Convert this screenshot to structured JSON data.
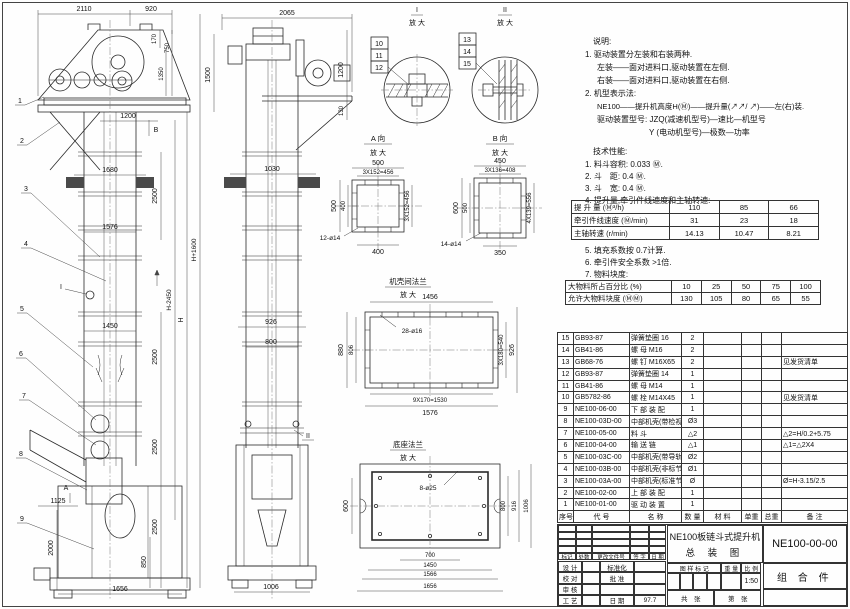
{
  "drawing": {
    "fv": {
      "d2110": "2110",
      "d920": "920",
      "d170": "170",
      "d750": "750",
      "d1350": "1350",
      "d1500": "1500",
      "d1200": "1200",
      "d1680": "1680",
      "d2500": "2500",
      "d1576": "1576",
      "d1450": "1450",
      "dH2450": "H-2450",
      "dH": "H",
      "dH1600": "H+1600",
      "d1125": "1125",
      "d2000": "2000",
      "d850": "850",
      "d1656": "1656",
      "mA": "A",
      "mB": "B",
      "mI": "I"
    },
    "sv": {
      "d2065": "2065",
      "d1200": "1200",
      "d130": "130",
      "d1030": "1030",
      "d926": "926",
      "d800": "800",
      "d1006": "1006",
      "mII": "II"
    },
    "det1": {
      "t": "I",
      "s": "放 大",
      "b1": "10",
      "b2": "11",
      "b3": "12"
    },
    "det2": {
      "t": "II",
      "s": "放 大",
      "b1": "13",
      "b2": "14",
      "b3": "15"
    },
    "va": {
      "t": "A 向",
      "s": "放 大",
      "top1": "500",
      "top2": "3X152=456",
      "l1": "500",
      "l2": "400",
      "r1": "3X152=456",
      "bot": "400",
      "leader": "12-ø14"
    },
    "vb": {
      "t": "B 向",
      "s": "放 大",
      "top1": "450",
      "top2": "3X136=408",
      "l1": "600",
      "l2": "500",
      "r1": "4X139=556",
      "bot": "350",
      "leader": "14-ø14"
    },
    "fm": {
      "t": "机壳间法兰",
      "s": "放 大",
      "top": "1456",
      "leader": "28-ø16",
      "l1": "880",
      "l2": "806",
      "r1": "3X180=540",
      "r2": "926",
      "b1": "9X170=1530",
      "b2": "1576"
    },
    "fb": {
      "t": "底座法兰",
      "s": "放 大",
      "leader": "8-ø25",
      "l1": "600",
      "r1": "800",
      "r2": "916",
      "r3": "1006",
      "b1": "700",
      "b2": "1450",
      "b3": "1566",
      "b4": "1656"
    },
    "bal": {
      "n1": "1",
      "n2": "2",
      "n3": "3",
      "n4": "4",
      "n5": "5",
      "n6": "6",
      "n7": "7",
      "n8": "8",
      "n9": "9"
    }
  },
  "notes": {
    "heading": "说明:",
    "l1": "1. 驱动装置分左装和右装两种.",
    "l2": "左装——面对进料口,驱动装置在左侧.",
    "l3": "右装——面对进料口,驱动装置在右侧.",
    "l4": "2. 机型表示法:",
    "l5": "NE100——提升机高度H(Ⓜ)——提升量(↗↗/ ↗)——左(右)装.",
    "l6": "驱动装置型号: JZQ(减速机型号)—速比—机型号",
    "l7": "Y (电动机型号)—极数—功率"
  },
  "tech": {
    "heading": "技术性能:",
    "i1": "1. 料斗容积: 0.033 Ⓜ.",
    "i2": "2. 斗　距: 0.4 Ⓜ.",
    "i3": "3. 斗　宽: 0.4 Ⓜ.",
    "i4": "4. 提升量,牵引件线速度和主轴转速:",
    "perf": {
      "rows": [
        {
          "label": "提 升 量  (Ⓜ³/h)",
          "v": [
            "110",
            "85",
            "66"
          ]
        },
        {
          "label": "牵引件线速度 (Ⓜ/min)",
          "v": [
            "31",
            "23",
            "18"
          ]
        },
        {
          "label": "主轴转速 (r/min)",
          "v": [
            "14.13",
            "10.47",
            "8.21"
          ]
        }
      ]
    },
    "i5": "5. 填充系数按 0.7计算.",
    "i6": "6. 牵引件安全系数 >1倍.",
    "i7": "7. 物料块度:",
    "lump": {
      "rows": [
        {
          "label": "大物料所占百分比 (%)",
          "v": [
            "10",
            "25",
            "50",
            "75",
            "100"
          ]
        },
        {
          "label": "允许大物料块度 (ⓂⓂ)",
          "v": [
            "130",
            "105",
            "80",
            "65",
            "55"
          ]
        }
      ]
    }
  },
  "bom": {
    "headers": [
      "序号",
      "代  号",
      "名    称",
      "数 量",
      "材  料",
      "单重",
      "总重",
      "备  注"
    ],
    "rows": [
      {
        "no": "15",
        "code": "GB93-87",
        "name": "弹簧垫圈 16",
        "qty": "2",
        "mat": "",
        "w1": "",
        "w2": "",
        "rem": ""
      },
      {
        "no": "14",
        "code": "GB41-86",
        "name": "螺  母  M16",
        "qty": "2",
        "mat": "",
        "w1": "",
        "w2": "",
        "rem": ""
      },
      {
        "no": "13",
        "code": "GB68-76",
        "name": "螺  钉  M16X65",
        "qty": "2",
        "mat": "",
        "w1": "",
        "w2": "",
        "rem": "见发货清单"
      },
      {
        "no": "12",
        "code": "GB93-87",
        "name": "弹簧垫圈 14",
        "qty": "1",
        "mat": "",
        "w1": "",
        "w2": "",
        "rem": ""
      },
      {
        "no": "11",
        "code": "GB41-86",
        "name": "螺  母  M14",
        "qty": "1",
        "mat": "",
        "w1": "",
        "w2": "",
        "rem": ""
      },
      {
        "no": "10",
        "code": "GB5782-86",
        "name": "螺  栓  M14X45",
        "qty": "1",
        "mat": "",
        "w1": "",
        "w2": "",
        "rem": "见发货清单"
      },
      {
        "no": "9",
        "code": "NE100-06-00",
        "name": "下 部 装 配",
        "qty": "1",
        "mat": "",
        "w1": "",
        "w2": "",
        "rem": ""
      },
      {
        "no": "8",
        "code": "NE100-03D-00",
        "name": "中部机壳(带检视门)",
        "qty": "Ø3",
        "mat": "",
        "w1": "",
        "w2": "",
        "rem": ""
      },
      {
        "no": "7",
        "code": "NE100-05-00",
        "name": "料  斗",
        "qty": "△2",
        "mat": "",
        "w1": "",
        "w2": "",
        "rem": "△2=H/0.2+5.75"
      },
      {
        "no": "6",
        "code": "NE100-04-00",
        "name": "输 送 链",
        "qty": "△1",
        "mat": "",
        "w1": "",
        "w2": "",
        "rem": "△1=△2X4"
      },
      {
        "no": "5",
        "code": "NE100-03C-00",
        "name": "中部机壳(带导轨)",
        "qty": "Ø2",
        "mat": "",
        "w1": "",
        "w2": "",
        "rem": ""
      },
      {
        "no": "4",
        "code": "NE100-03B-00",
        "name": "中部机壳(非标节1.5Ⓜ,1Ⓜ)",
        "qty": "Ø1",
        "mat": "",
        "w1": "",
        "w2": "",
        "rem": ""
      },
      {
        "no": "3",
        "code": "NE100-03A-00",
        "name": "中部机壳(标准节2.5Ⓜ)",
        "qty": "Ø",
        "mat": "",
        "w1": "",
        "w2": "",
        "rem": "Ø=H-3.15/2.5"
      },
      {
        "no": "2",
        "code": "NE100-02-00",
        "name": "上 部 装 配",
        "qty": "1",
        "mat": "",
        "w1": "",
        "w2": "",
        "rem": ""
      },
      {
        "no": "1",
        "code": "NE100-01-00",
        "name": "驱 动 装 置",
        "qty": "1",
        "mat": "",
        "w1": "",
        "w2": "",
        "rem": ""
      }
    ]
  },
  "titleblock": {
    "rev_cols": [
      "标记",
      "处数",
      "更改文件号",
      "签 字",
      "日 期"
    ],
    "r1l": "设 计",
    "r1m": "标准化",
    "r2l": "校 对",
    "r2m": "批 准",
    "r3l": "审 核",
    "r4l": "工 艺",
    "r4m": "日 期",
    "r4v": "97.7",
    "title1": "NE100板链斗式提升机",
    "title2": "总  装  图",
    "mark_head": "图 样 标 记",
    "weight_head": "重 量",
    "scale_head": "比 例",
    "scale": "1:50",
    "sheets": "共　张",
    "sheet_no": "第　张",
    "dwg_no": "NE100-00-00",
    "part_type": "组 合 件"
  }
}
